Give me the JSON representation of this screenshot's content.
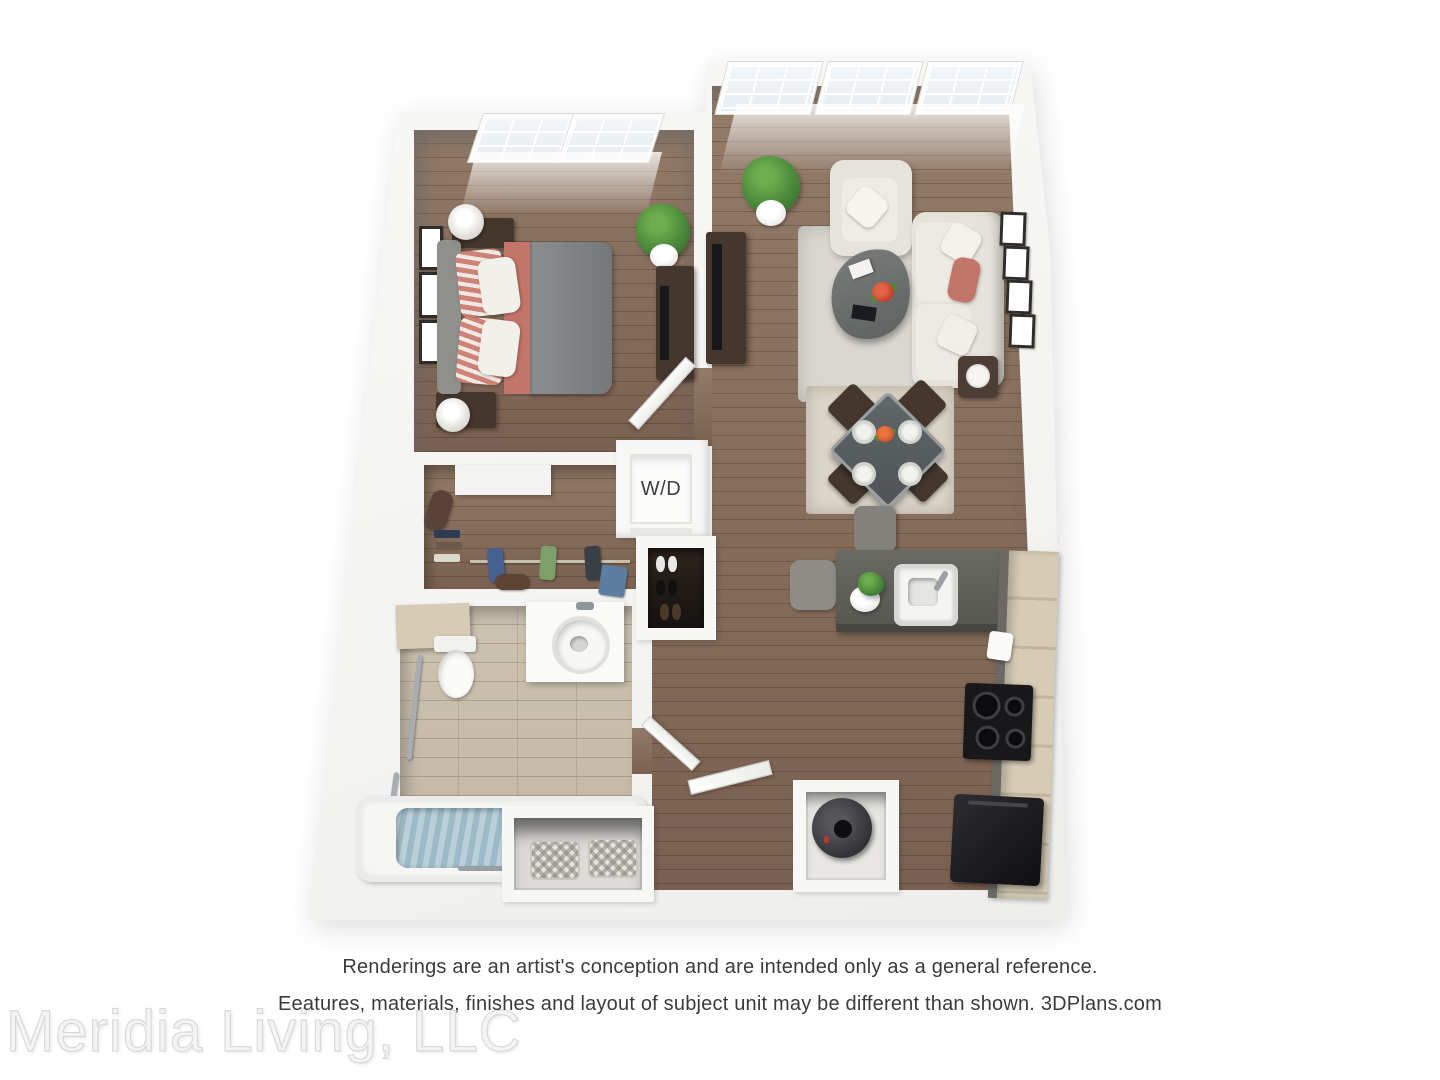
{
  "window": {
    "width": 1440,
    "height": 1080,
    "background": "#ffffff"
  },
  "floorplan": {
    "type": "3d-apartment-floor-plan-rendering",
    "rooms": [
      "bedroom",
      "living-room",
      "dining-area",
      "kitchen",
      "bathroom",
      "walk-in-closet",
      "laundry-closet",
      "entry"
    ],
    "labels": {
      "washer_dryer": "W/D"
    },
    "colors": {
      "wall": "#f4f4f3",
      "wood_floor": "#937b68",
      "wood_floor_dark": "#7a6050",
      "bathroom_tile": "#ccc2b0",
      "kitchen_counter": "#6a6963",
      "cabinet_wood": "#d6ccb6",
      "accent_coral": "#c4756a",
      "upholstery_cream": "#e6e3dc",
      "rug_gray": "#dad7d1",
      "rug_beige": "#dcd6c9",
      "plant_green": "#4c8a3c",
      "tub_water": "#9db8c6",
      "dark_wood_furniture": "#44372e",
      "appliance_black": "#18181a",
      "text_dark": "#3b3b3b",
      "watermark_gray": "#f4f4f4"
    }
  },
  "disclaimer": {
    "line1": "Renderings are an artist's conception and are intended only as a general reference.",
    "line2": "Eeatures, materials, finishes and layout of subject unit may be different than shown. 3DPlans.com"
  },
  "site_credit": "3DPlans.com",
  "watermark": {
    "text": "Meridia Living, LLC"
  }
}
